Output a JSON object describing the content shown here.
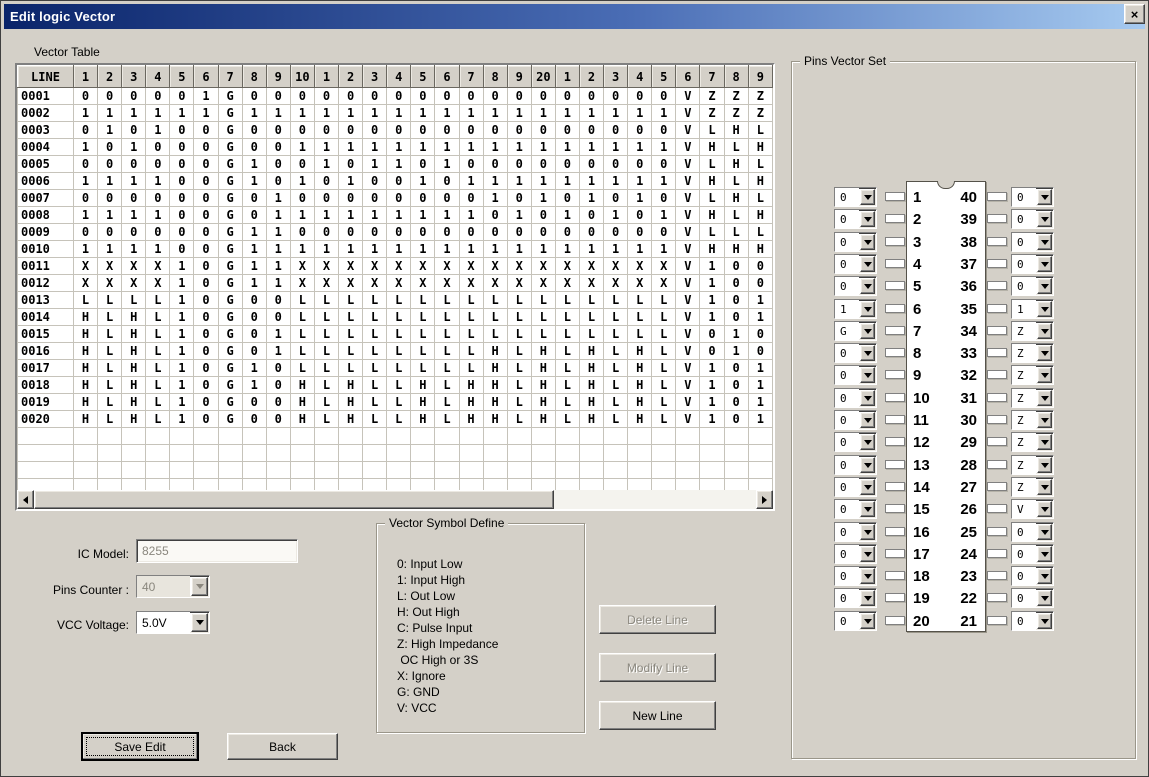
{
  "window": {
    "title": "Edit logic Vector",
    "close_glyph": "×"
  },
  "colors": {
    "dialog_bg": "#d4d0c8",
    "titlebar_gradient_left": "#0a246a",
    "titlebar_gradient_right": "#a6caf0",
    "disabled_text": "#8a877e"
  },
  "vector_table": {
    "label": "Vector Table",
    "headers": [
      "LINE",
      "1",
      "2",
      "3",
      "4",
      "5",
      "6",
      "7",
      "8",
      "9",
      "10",
      "1",
      "2",
      "3",
      "4",
      "5",
      "6",
      "7",
      "8",
      "9",
      "20",
      "1",
      "2",
      "3",
      "4",
      "5",
      "6",
      "7",
      "8",
      "9"
    ],
    "rows": [
      {
        "line": "0001",
        "values": [
          "0",
          "0",
          "0",
          "0",
          "0",
          "1",
          "G",
          "0",
          "0",
          "0",
          "0",
          "0",
          "0",
          "0",
          "0",
          "0",
          "0",
          "0",
          "0",
          "0",
          "0",
          "0",
          "0",
          "0",
          "0",
          "V",
          "Z",
          "Z",
          "Z"
        ]
      },
      {
        "line": "0002",
        "values": [
          "1",
          "1",
          "1",
          "1",
          "1",
          "1",
          "G",
          "1",
          "1",
          "1",
          "1",
          "1",
          "1",
          "1",
          "1",
          "1",
          "1",
          "1",
          "1",
          "1",
          "1",
          "1",
          "1",
          "1",
          "1",
          "V",
          "Z",
          "Z",
          "Z"
        ]
      },
      {
        "line": "0003",
        "values": [
          "0",
          "1",
          "0",
          "1",
          "0",
          "0",
          "G",
          "0",
          "0",
          "0",
          "0",
          "0",
          "0",
          "0",
          "0",
          "0",
          "0",
          "0",
          "0",
          "0",
          "0",
          "0",
          "0",
          "0",
          "0",
          "V",
          "L",
          "H",
          "L"
        ]
      },
      {
        "line": "0004",
        "values": [
          "1",
          "0",
          "1",
          "0",
          "0",
          "0",
          "G",
          "0",
          "0",
          "1",
          "1",
          "1",
          "1",
          "1",
          "1",
          "1",
          "1",
          "1",
          "1",
          "1",
          "1",
          "1",
          "1",
          "1",
          "1",
          "V",
          "H",
          "L",
          "H"
        ]
      },
      {
        "line": "0005",
        "values": [
          "0",
          "0",
          "0",
          "0",
          "0",
          "0",
          "G",
          "1",
          "0",
          "0",
          "1",
          "0",
          "1",
          "1",
          "0",
          "1",
          "0",
          "0",
          "0",
          "0",
          "0",
          "0",
          "0",
          "0",
          "0",
          "V",
          "L",
          "H",
          "L"
        ]
      },
      {
        "line": "0006",
        "values": [
          "1",
          "1",
          "1",
          "1",
          "0",
          "0",
          "G",
          "1",
          "0",
          "1",
          "0",
          "1",
          "0",
          "0",
          "1",
          "0",
          "1",
          "1",
          "1",
          "1",
          "1",
          "1",
          "1",
          "1",
          "1",
          "V",
          "H",
          "L",
          "H"
        ]
      },
      {
        "line": "0007",
        "values": [
          "0",
          "0",
          "0",
          "0",
          "0",
          "0",
          "G",
          "0",
          "1",
          "0",
          "0",
          "0",
          "0",
          "0",
          "0",
          "0",
          "0",
          "1",
          "0",
          "1",
          "0",
          "1",
          "0",
          "1",
          "0",
          "V",
          "L",
          "H",
          "L"
        ]
      },
      {
        "line": "0008",
        "values": [
          "1",
          "1",
          "1",
          "1",
          "0",
          "0",
          "G",
          "0",
          "1",
          "1",
          "1",
          "1",
          "1",
          "1",
          "1",
          "1",
          "1",
          "0",
          "1",
          "0",
          "1",
          "0",
          "1",
          "0",
          "1",
          "V",
          "H",
          "L",
          "H"
        ]
      },
      {
        "line": "0009",
        "values": [
          "0",
          "0",
          "0",
          "0",
          "0",
          "0",
          "G",
          "1",
          "1",
          "0",
          "0",
          "0",
          "0",
          "0",
          "0",
          "0",
          "0",
          "0",
          "0",
          "0",
          "0",
          "0",
          "0",
          "0",
          "0",
          "V",
          "L",
          "L",
          "L"
        ]
      },
      {
        "line": "0010",
        "values": [
          "1",
          "1",
          "1",
          "1",
          "0",
          "0",
          "G",
          "1",
          "1",
          "1",
          "1",
          "1",
          "1",
          "1",
          "1",
          "1",
          "1",
          "1",
          "1",
          "1",
          "1",
          "1",
          "1",
          "1",
          "1",
          "V",
          "H",
          "H",
          "H"
        ]
      },
      {
        "line": "0011",
        "values": [
          "X",
          "X",
          "X",
          "X",
          "1",
          "0",
          "G",
          "1",
          "1",
          "X",
          "X",
          "X",
          "X",
          "X",
          "X",
          "X",
          "X",
          "X",
          "X",
          "X",
          "X",
          "X",
          "X",
          "X",
          "X",
          "V",
          "1",
          "0",
          "0"
        ]
      },
      {
        "line": "0012",
        "values": [
          "X",
          "X",
          "X",
          "X",
          "1",
          "0",
          "G",
          "1",
          "1",
          "X",
          "X",
          "X",
          "X",
          "X",
          "X",
          "X",
          "X",
          "X",
          "X",
          "X",
          "X",
          "X",
          "X",
          "X",
          "X",
          "V",
          "1",
          "0",
          "0"
        ]
      },
      {
        "line": "0013",
        "values": [
          "L",
          "L",
          "L",
          "L",
          "1",
          "0",
          "G",
          "0",
          "0",
          "L",
          "L",
          "L",
          "L",
          "L",
          "L",
          "L",
          "L",
          "L",
          "L",
          "L",
          "L",
          "L",
          "L",
          "L",
          "L",
          "V",
          "1",
          "0",
          "1"
        ]
      },
      {
        "line": "0014",
        "values": [
          "H",
          "L",
          "H",
          "L",
          "1",
          "0",
          "G",
          "0",
          "0",
          "L",
          "L",
          "L",
          "L",
          "L",
          "L",
          "L",
          "L",
          "L",
          "L",
          "L",
          "L",
          "L",
          "L",
          "L",
          "L",
          "V",
          "1",
          "0",
          "1"
        ]
      },
      {
        "line": "0015",
        "values": [
          "H",
          "L",
          "H",
          "L",
          "1",
          "0",
          "G",
          "0",
          "1",
          "L",
          "L",
          "L",
          "L",
          "L",
          "L",
          "L",
          "L",
          "L",
          "L",
          "L",
          "L",
          "L",
          "L",
          "L",
          "L",
          "V",
          "0",
          "1",
          "0"
        ]
      },
      {
        "line": "0016",
        "values": [
          "H",
          "L",
          "H",
          "L",
          "1",
          "0",
          "G",
          "0",
          "1",
          "L",
          "L",
          "L",
          "L",
          "L",
          "L",
          "L",
          "L",
          "H",
          "L",
          "H",
          "L",
          "H",
          "L",
          "H",
          "L",
          "V",
          "0",
          "1",
          "0"
        ]
      },
      {
        "line": "0017",
        "values": [
          "H",
          "L",
          "H",
          "L",
          "1",
          "0",
          "G",
          "1",
          "0",
          "L",
          "L",
          "L",
          "L",
          "L",
          "L",
          "L",
          "L",
          "H",
          "L",
          "H",
          "L",
          "H",
          "L",
          "H",
          "L",
          "V",
          "1",
          "0",
          "1"
        ]
      },
      {
        "line": "0018",
        "values": [
          "H",
          "L",
          "H",
          "L",
          "1",
          "0",
          "G",
          "1",
          "0",
          "H",
          "L",
          "H",
          "L",
          "L",
          "H",
          "L",
          "H",
          "H",
          "L",
          "H",
          "L",
          "H",
          "L",
          "H",
          "L",
          "V",
          "1",
          "0",
          "1"
        ]
      },
      {
        "line": "0019",
        "values": [
          "H",
          "L",
          "H",
          "L",
          "1",
          "0",
          "G",
          "0",
          "0",
          "H",
          "L",
          "H",
          "L",
          "L",
          "H",
          "L",
          "H",
          "H",
          "L",
          "H",
          "L",
          "H",
          "L",
          "H",
          "L",
          "V",
          "1",
          "0",
          "1"
        ]
      },
      {
        "line": "0020",
        "values": [
          "H",
          "L",
          "H",
          "L",
          "1",
          "0",
          "G",
          "0",
          "0",
          "H",
          "L",
          "H",
          "L",
          "L",
          "H",
          "L",
          "H",
          "H",
          "L",
          "H",
          "L",
          "H",
          "L",
          "H",
          "L",
          "V",
          "1",
          "0",
          "1"
        ]
      }
    ],
    "empty_rows": 4
  },
  "form": {
    "ic_model_label": "IC Model:",
    "ic_model_value": "8255",
    "pins_counter_label": "Pins Counter :",
    "pins_counter_value": "40",
    "vcc_voltage_label": "VCC Voltage:",
    "vcc_voltage_value": "5.0V"
  },
  "symbol_define": {
    "title": "Vector Symbol Define",
    "lines": [
      "0: Input Low",
      "1: Input High",
      "L: Out Low",
      "H: Out High",
      "C: Pulse Input",
      "Z: High Impedance",
      " OC High or 3S",
      "X: Ignore",
      "G: GND",
      "V: VCC"
    ]
  },
  "buttons": {
    "delete_line": "Delete Line",
    "modify_line": "Modify Line",
    "new_line": "New Line",
    "save_edit": "Save Edit",
    "back": "Back"
  },
  "pins_vector_set": {
    "title": "Pins Vector Set",
    "left_pins": [
      {
        "pin": 1,
        "value": "0"
      },
      {
        "pin": 2,
        "value": "0"
      },
      {
        "pin": 3,
        "value": "0"
      },
      {
        "pin": 4,
        "value": "0"
      },
      {
        "pin": 5,
        "value": "0"
      },
      {
        "pin": 6,
        "value": "1"
      },
      {
        "pin": 7,
        "value": "G"
      },
      {
        "pin": 8,
        "value": "0"
      },
      {
        "pin": 9,
        "value": "0"
      },
      {
        "pin": 10,
        "value": "0"
      },
      {
        "pin": 11,
        "value": "0"
      },
      {
        "pin": 12,
        "value": "0"
      },
      {
        "pin": 13,
        "value": "0"
      },
      {
        "pin": 14,
        "value": "0"
      },
      {
        "pin": 15,
        "value": "0"
      },
      {
        "pin": 16,
        "value": "0"
      },
      {
        "pin": 17,
        "value": "0"
      },
      {
        "pin": 18,
        "value": "0"
      },
      {
        "pin": 19,
        "value": "0"
      },
      {
        "pin": 20,
        "value": "0"
      }
    ],
    "right_pins": [
      {
        "pin": 40,
        "value": "0"
      },
      {
        "pin": 39,
        "value": "0"
      },
      {
        "pin": 38,
        "value": "0"
      },
      {
        "pin": 37,
        "value": "0"
      },
      {
        "pin": 36,
        "value": "0"
      },
      {
        "pin": 35,
        "value": "1"
      },
      {
        "pin": 34,
        "value": "Z"
      },
      {
        "pin": 33,
        "value": "Z"
      },
      {
        "pin": 32,
        "value": "Z"
      },
      {
        "pin": 31,
        "value": "Z"
      },
      {
        "pin": 30,
        "value": "Z"
      },
      {
        "pin": 29,
        "value": "Z"
      },
      {
        "pin": 28,
        "value": "Z"
      },
      {
        "pin": 27,
        "value": "Z"
      },
      {
        "pin": 26,
        "value": "V"
      },
      {
        "pin": 25,
        "value": "0"
      },
      {
        "pin": 24,
        "value": "0"
      },
      {
        "pin": 23,
        "value": "0"
      },
      {
        "pin": 22,
        "value": "0"
      },
      {
        "pin": 21,
        "value": "0"
      }
    ]
  }
}
